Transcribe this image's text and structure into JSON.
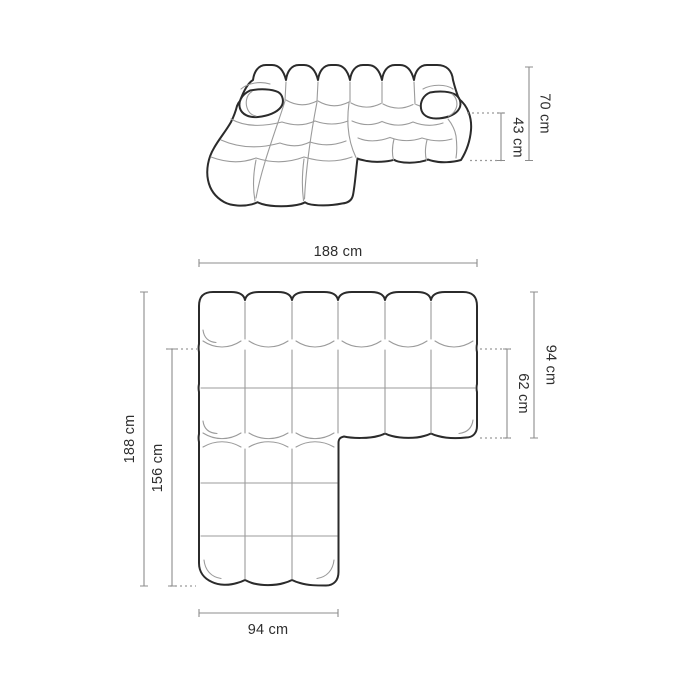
{
  "diagram": {
    "type": "sofa-dimension-drawing",
    "views": {
      "perspective": {
        "dims": {
          "total_height": "70 cm",
          "seat_height": "43 cm"
        }
      },
      "plan": {
        "dims": {
          "total_width": "188 cm",
          "total_depth": "188 cm",
          "chaise_length": "156 cm",
          "side_depth": "94 cm",
          "seat_depth": "62 cm",
          "chaise_width": "94 cm"
        }
      }
    }
  },
  "colors": {
    "background": "#ffffff",
    "outline": "#2b2b2b",
    "seam": "#9b9b9b",
    "dimension_line": "#8c8c8c",
    "text": "#2e2e2e"
  }
}
